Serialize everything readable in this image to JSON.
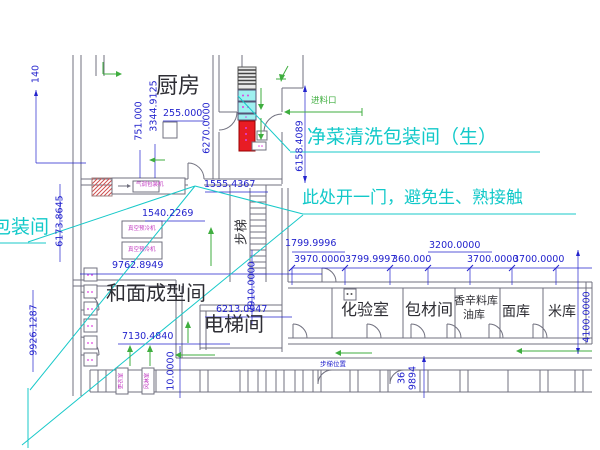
{
  "notes": {
    "packaging_room": "包装间",
    "clean_veg_room": "净菜清洗包装间（生）",
    "door_note": "此处开一门，避免生、熟接触"
  },
  "rooms": {
    "kitchen": "厨房",
    "dough_forming": "和面成型间",
    "elevator": "电梯间",
    "stairs": "步梯",
    "lab": "化验室",
    "packaging_material": "包材间",
    "spice_store_line1": "香辛料库",
    "spice_store_line2": "油库",
    "flour_store": "面库",
    "rice_store": "米库"
  },
  "green_labels": {
    "feed_inlet": "进料口"
  },
  "equipment": {
    "map_packer": "气调包装机",
    "vacuum_cooler_1": "真空预冷机",
    "vacuum_cooler_2": "真空预冷机",
    "changing_room": "更衣室",
    "air_shower": "风淋室",
    "position_note": "步梯位置"
  },
  "dimensions": {
    "d140": "140",
    "d751": "751.000",
    "d3344": "3344.9125",
    "d255": "255.000",
    "d6270": "6270.0000",
    "d6158": "6158.4089",
    "d1555": "1555.4367",
    "d1540": "1540.2269",
    "d6173": "6173.8645",
    "d9762": "9762.8949",
    "d9926": "9926.1287",
    "d7130": "7130.4840",
    "d6213": "6213.0947",
    "d7910": "7910.0000",
    "d1799": "1799.9996",
    "d3970": "3970.0000",
    "d3799": "3799.9997",
    "d360": "360.000",
    "d3200": "3200.0000",
    "d3700a": "3700.0000",
    "d3700b": "3700.0000",
    "d4100": "4100.0000",
    "d10": "10.0000",
    "d36": "36",
    "d9894": "9894"
  },
  "colors": {
    "dimension_text": "#2323cd",
    "note_text": "#12c9c9",
    "room_text": "#2e2e34",
    "flow_arrow_green": "#3fae3f",
    "equipment_text_magenta": "#c23cc2",
    "wall_gray": "#71717f",
    "machine_red": "#e81c24",
    "machine_cyan": "#9ff0f0",
    "hatch_red": "#d05050"
  }
}
